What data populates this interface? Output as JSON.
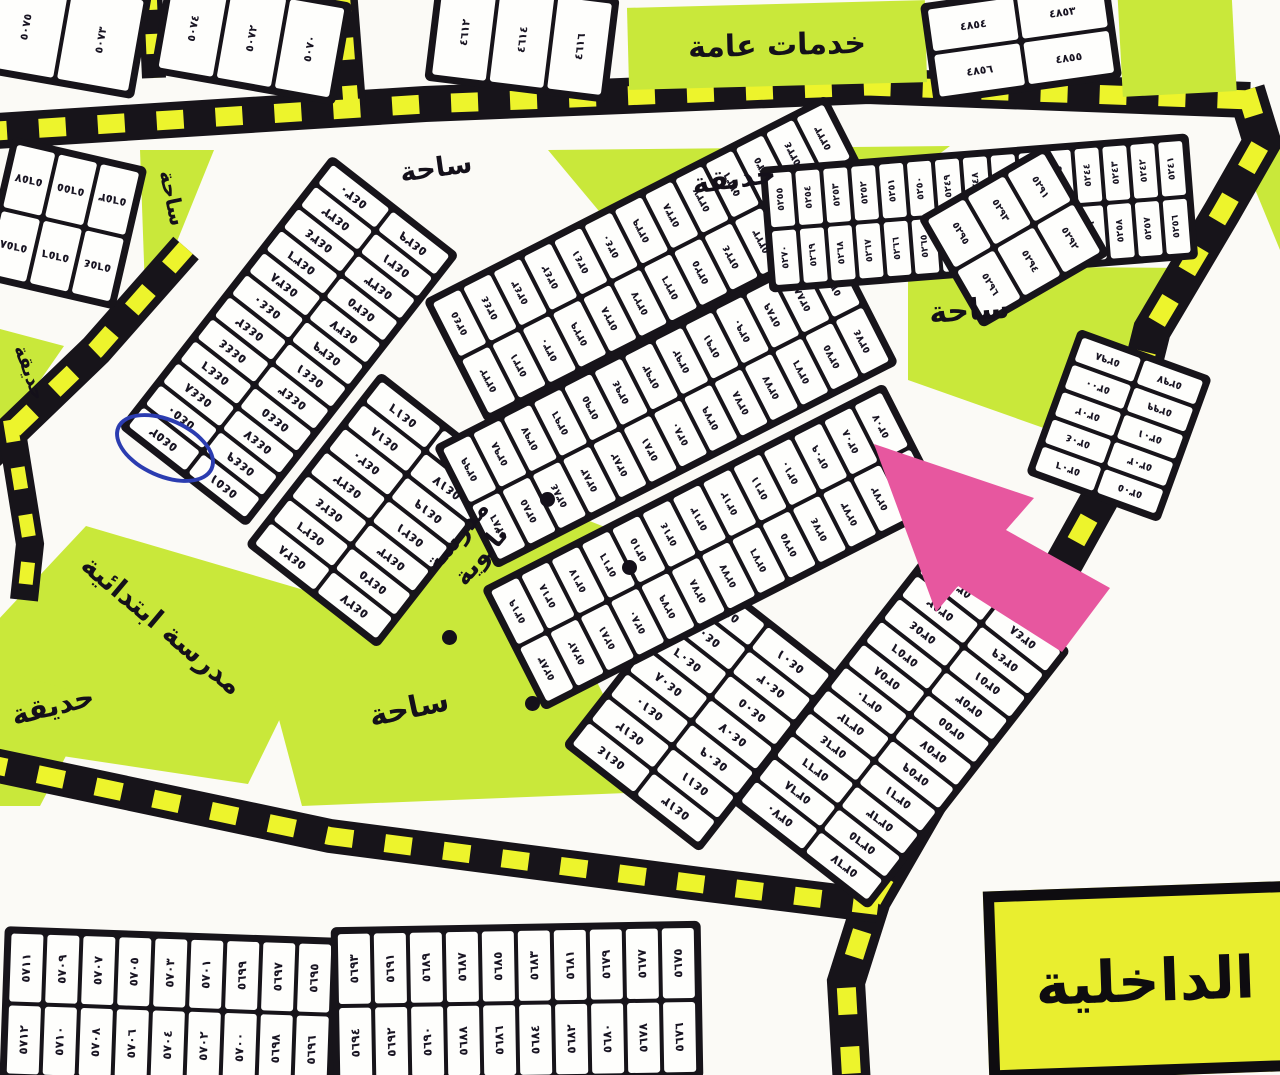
{
  "colors": {
    "green_area": "#c9e83a",
    "road_black": "#17141a",
    "dash_yellow": "#edf42c",
    "pink_arrow": "#e7579f",
    "box_yellow": "#e9ee2f",
    "pen_blue": "#2b3cb0",
    "paper": "#fbfaf6"
  },
  "labels": {
    "public_services": "خدمات عامة",
    "plaza": "ساحة",
    "garden": "حديقة",
    "elementary_school": "مدرسة ابتدائية",
    "secondary_school": "مدرسة ثانوية",
    "interior": "الداخلية"
  },
  "annotations": {
    "circled_plot": "٥٤٥٢",
    "arrow_note": "pink locator arrow pointing at plot row"
  },
  "blocks": [
    {
      "id": "a1",
      "rows": [
        [
          "٥٠٧٥",
          "٥٠٧٣"
        ]
      ]
    },
    {
      "id": "a2",
      "rows": [
        [
          "٥٠٧٤",
          "٥٠٧٢",
          "٥٠٧٠"
        ]
      ]
    },
    {
      "id": "b",
      "rows": [
        [
          "٤٦١٢",
          "٤٦١٤",
          "٤٦١٦"
        ]
      ]
    },
    {
      "id": "d",
      "rows": [
        [
          "٤٨٥٤",
          "٤٨٥٣"
        ],
        [
          "٤٨٥٦",
          "٤٨٥٥"
        ]
      ]
    },
    {
      "id": "e",
      "rows": [
        [
          "٥٦٥٧",
          "٥٦٥٥",
          "٥٦٥٣"
        ],
        [
          "٥٦٥٨",
          "٥٦٥٦",
          "٥٦٥٤"
        ]
      ]
    },
    {
      "id": "h",
      "rows": [
        [
          "٥٤٣٠",
          "٥٤٢٩"
        ],
        [
          "٥٤٣٢",
          "٥٤٣١"
        ],
        [
          "٥٤٣٤",
          "٥٤٣٣"
        ],
        [
          "٥٤٣٦",
          "٥٤٣٥"
        ],
        [
          "٥٤٣٨",
          "٥٤٣٧"
        ],
        [
          "٥٤٤٠",
          "٥٤٣٩"
        ],
        [
          "٥٤٤٢",
          "٥٤٤١"
        ],
        [
          "٥٤٤٤",
          "٥٤٤٣"
        ],
        [
          "٥٤٤٦",
          "٥٤٤٥"
        ],
        [
          "٥٤٤٨",
          "٥٤٤٧"
        ],
        [
          "٥٤٥٠",
          "٥٤٤٩"
        ],
        [
          "٥٤٥٢",
          "٥٤٥١"
        ]
      ]
    },
    {
      "id": "i",
      "rows": [
        [
          "٥٤١٦",
          "٥٤١٥"
        ],
        [
          "٥٤١٨",
          "٥٤١٧"
        ],
        [
          "٥٤٢٠",
          "٥٤١٩"
        ],
        [
          "٥٤٢٢",
          "٥٤٢١"
        ],
        [
          "٥٤٢٤",
          "٥٤٢٣"
        ],
        [
          "٥٤٢٦",
          "٥٤٢٥"
        ],
        [
          "٥٤٢٨",
          "٥٤٢٧"
        ]
      ]
    },
    {
      "id": "j",
      "rows": [
        [
          "٥٤٠٢",
          "٥٤٠١"
        ],
        [
          "٥٤٠٤",
          "٥٤٠٣"
        ],
        [
          "٥٤٠٦",
          "٥٤٠٥"
        ],
        [
          "٥٤٠٨",
          "٥٤٠٧"
        ],
        [
          "٥٤١٠",
          "٥٤٠٩"
        ],
        [
          "٥٤١٢",
          "٥٤١١"
        ],
        [
          "٥٤١٤",
          "٥٤١٣"
        ]
      ]
    },
    {
      "id": "br",
      "rows": [
        [
          "٥٣٥٠",
          "٥٣٤٨"
        ],
        [
          "٥٣٥٢",
          "٥٣٤٩"
        ],
        [
          "٥٣٥٤",
          "٥٣٥١"
        ],
        [
          "٥٣٥٦",
          "٥٣٥٣"
        ],
        [
          "٥٣٥٨",
          "٥٣٥٥"
        ],
        [
          "٥٣٦٠",
          "٥٣٥٧"
        ],
        [
          "٥٣٦٢",
          "٥٣٥٩"
        ],
        [
          "٥٣٦٤",
          "٥٣٦١"
        ],
        [
          "٥٣٦٦",
          "٥٣٦٣"
        ],
        [
          "٥٣٦٨",
          "٥٣٦٥"
        ],
        [
          "٥٣٧٠",
          "٥٣٦٧"
        ]
      ]
    },
    {
      "id": "s1",
      "rows": [
        [
          "٥٣٤٥",
          "٥٣٤٤",
          "٥٣٤٣",
          "٥٣٤٢",
          "٥٣٤١",
          "٥٣٤٠",
          "٥٣٣٩",
          "٥٣٣٨",
          "٥٣٣٧",
          "٥٣٣٦",
          "٥٣٣٥",
          "٥٣٣٤",
          "٥٣٣٣"
        ],
        [
          "٥٣٣٢",
          "٥٣٣١",
          "٥٣٣٠",
          "٥٣٢٩",
          "٥٣٢٨",
          "٥٣٢٧",
          "٥٣٢٦",
          "٥٣٢٥",
          "٥٣٢٤",
          "٥٣٢٣",
          "٥٣٢٢",
          "٥٣٢١",
          "٥٣٢٠"
        ]
      ]
    },
    {
      "id": "s2",
      "rows": [
        [
          "٥٣٩٩",
          "٥٣٩٨",
          "٥٣٩٧",
          "٥٣٩٦",
          "٥٣٩٥",
          "٥٣٩٤",
          "٥٣٩٣",
          "٥٣٩٢",
          "٥٣٩١",
          "٥٣٩٠",
          "٥٣٨٩",
          "٥٣٨٨",
          "٥٣٨٧"
        ],
        [
          "٥٣٨٦",
          "٥٣٨٥",
          "٥٣٨٤",
          "٥٣٨٣",
          "٥٣٨٢",
          "٥٣٨١",
          "٥٣٨٠",
          "٥٣٧٩",
          "٥٣٧٨",
          "٥٣٧٧",
          "٥٣٧٦",
          "٥٣٧٥",
          "٥٣٧٤"
        ]
      ]
    },
    {
      "id": "s3",
      "rows": [
        [
          "٥٣١٩",
          "٥٣١٨",
          "٥٣١٧",
          "٥٣١٦",
          "٥٣١٥",
          "٥٣١٤",
          "٥٣١٣",
          "٥٣١٢",
          "٥٣١١",
          "٥٣١٠",
          "٥٣٠٩",
          "٥٣٠٨",
          "٥٣٠٧"
        ],
        [
          "٥٢٨٣",
          "٥٢٨٢",
          "٥٢٨١",
          "٥٢٨٠",
          "٥٢٧٩",
          "٥٢٧٨",
          "٥٢٧٧",
          "٥٢٧٦",
          "٥٢٧٥",
          "٥٢٧٤",
          "٥٢٧٣",
          "٥٢٧٢",
          "٥٢٧١"
        ]
      ]
    },
    {
      "id": "tr",
      "rows": [
        [
          "٥٢٥٥",
          "٥٢٥٤",
          "٥٢٥٣",
          "٥٢٥٢",
          "٥٢٥١",
          "٥٢٥٠",
          "٥٢٤٩",
          "٥٢٤٨",
          "٥٢٤٧",
          "٥٢٤٦",
          "٥٢٤٥",
          "٥٢٤٤",
          "٥٢٤٣",
          "٥٢٤٢",
          "٥٢٤١"
        ],
        [
          "٥٢٧٠",
          "٥٢٦٩",
          "٥٢٦٨",
          "٥٢٦٧",
          "٥٢٦٦",
          "٥٢٦٥",
          "٥٢٦٤",
          "٥٢٦٣",
          "٥٢٦٢",
          "٥٢٦١",
          "٥٢٦٠",
          "٥٢٥٩",
          "٥٢٥٨",
          "٥٢٥٧",
          "٥٢٥٦"
        ]
      ]
    },
    {
      "id": "sb",
      "rows": [
        [
          "٥٢٩٥",
          "٥٢٩٣",
          "٥٢٩١"
        ],
        [
          "٥٢٩٦",
          "٥٢٩٤",
          "٥٢٩٢"
        ]
      ]
    },
    {
      "id": "tr2",
      "rows": [
        [
          "٥٢٩٨",
          "٥٢٩٧"
        ],
        [
          "٥٣٠٠",
          "٥٢٩٩"
        ],
        [
          "٥٣٠٢",
          "٥٣٠١"
        ],
        [
          "٥٣٠٤",
          "٥٣٠٣"
        ],
        [
          "٥٣٠٦",
          "٥٣٠٥"
        ]
      ]
    },
    {
      "id": "bl1",
      "rows": [
        [
          "٥٧١١",
          "٥٧٠٩",
          "٥٧٠٧",
          "٥٧٠٥",
          "٥٧٠٣",
          "٥٧٠١",
          "٥٦٩٩",
          "٥٦٩٧",
          "٥٦٩٥"
        ],
        [
          "٥٧١٢",
          "٥٧١٠",
          "٥٧٠٨",
          "٥٧٠٦",
          "٥٧٠٤",
          "٥٧٠٢",
          "٥٧٠٠",
          "٥٦٩٨",
          "٥٦٩٦"
        ]
      ]
    },
    {
      "id": "bl2",
      "rows": [
        [
          "٥٦٩٣",
          "٥٦٩١",
          "٥٦٨٩",
          "٥٦٨٧",
          "٥٦٨٥",
          "٥٦٨٣",
          "٥٦٨١",
          "٥٦٧٩",
          "٥٦٧٧",
          "٥٦٧٥"
        ],
        [
          "٥٦٩٤",
          "٥٦٩٢",
          "٥٦٩٠",
          "٥٦٨٨",
          "٥٦٨٦",
          "٥٦٨٤",
          "٥٦٨٢",
          "٥٦٨٠",
          "٥٦٧٨",
          "٥٦٧٦"
        ]
      ]
    }
  ]
}
